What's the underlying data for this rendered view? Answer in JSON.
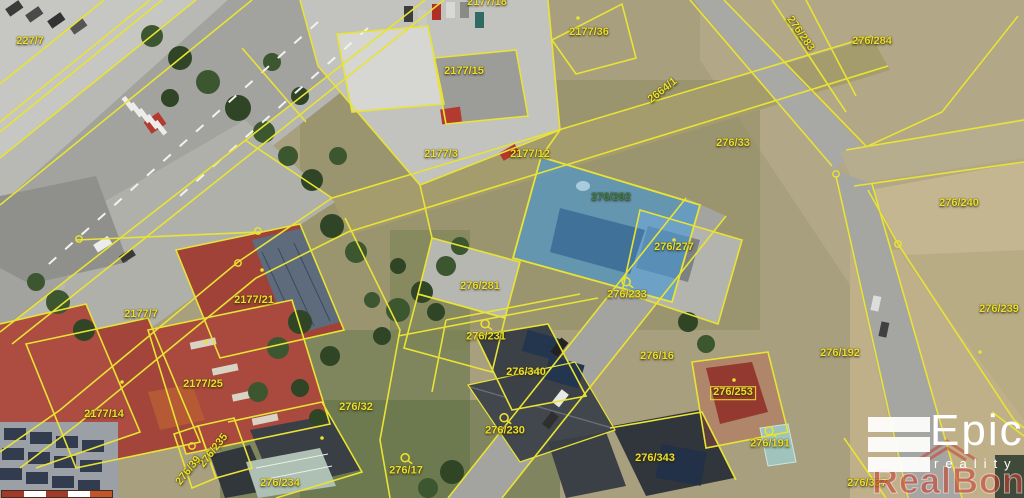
{
  "map": {
    "type": "cadastral-aerial-view",
    "selected_parcel": "276/292",
    "colors": {
      "boundary": "#e8e334",
      "label": "#ecdf2e",
      "selected_parcel_fill": "rgba(70,150,210,0.65)",
      "selected_parcel_label": "#3f7d52",
      "watermark_red": "rgba(198,62,46,0.58)"
    },
    "labels": [
      {
        "text": "227/7",
        "x": 30,
        "y": 42
      },
      {
        "text": "2177/18",
        "x": 487,
        "y": 3
      },
      {
        "text": "2177/36",
        "x": 589,
        "y": 33
      },
      {
        "text": "2177/15",
        "x": 464,
        "y": 72
      },
      {
        "text": "2177/3",
        "x": 441,
        "y": 155
      },
      {
        "text": "2177/12",
        "x": 530,
        "y": 155
      },
      {
        "text": "2664/1",
        "x": 663,
        "y": 91,
        "rot": -38
      },
      {
        "text": "276/283",
        "x": 800,
        "y": 34,
        "rot": 55
      },
      {
        "text": "276/284",
        "x": 872,
        "y": 42
      },
      {
        "text": "276/33",
        "x": 733,
        "y": 144
      },
      {
        "text": "276/240",
        "x": 959,
        "y": 204
      },
      {
        "text": "276/239",
        "x": 999,
        "y": 310
      },
      {
        "text": "276/292",
        "x": 611,
        "y": 198,
        "color": "#3f7d52"
      },
      {
        "text": "276/277",
        "x": 674,
        "y": 248
      },
      {
        "text": "276/281",
        "x": 480,
        "y": 287
      },
      {
        "text": "276/233",
        "x": 627,
        "y": 289,
        "icon": "well-icon"
      },
      {
        "text": "276/231",
        "x": 486,
        "y": 331,
        "icon": "well-icon"
      },
      {
        "text": "276/16",
        "x": 657,
        "y": 357
      },
      {
        "text": "276/192",
        "x": 840,
        "y": 354
      },
      {
        "text": "2177/7",
        "x": 141,
        "y": 315
      },
      {
        "text": "2177/21",
        "x": 254,
        "y": 301
      },
      {
        "text": "2177/25",
        "x": 203,
        "y": 385
      },
      {
        "text": "2177/14",
        "x": 104,
        "y": 415
      },
      {
        "text": "276/32",
        "x": 356,
        "y": 408
      },
      {
        "text": "276/340",
        "x": 526,
        "y": 373
      },
      {
        "text": "276/230",
        "x": 505,
        "y": 425,
        "icon": "well-icon"
      },
      {
        "text": "276/17",
        "x": 406,
        "y": 465,
        "icon": "well-icon"
      },
      {
        "text": "276/234",
        "x": 280,
        "y": 484
      },
      {
        "text": "276/235",
        "x": 214,
        "y": 451,
        "rot": -52
      },
      {
        "text": "276/39",
        "x": 189,
        "y": 471,
        "rot": -52
      },
      {
        "text": "276/253",
        "x": 733,
        "y": 393,
        "boxed": true
      },
      {
        "text": "276/191",
        "x": 770,
        "y": 438,
        "icon": "well-icon"
      },
      {
        "text": "276/343",
        "x": 655,
        "y": 459
      },
      {
        "text": "276/337",
        "x": 867,
        "y": 484
      }
    ]
  },
  "logo": {
    "title": "Epic",
    "subtitle": "reality",
    "bars_icon": "epic-logo-bars-icon"
  },
  "watermark": {
    "text": "RealBonus",
    "icon": "roof-icon"
  },
  "scale_bar": {
    "segments": [
      "#9e3b2b",
      "#ffffff",
      "#9e3b2b",
      "#ffffff",
      "#c0562c"
    ]
  }
}
